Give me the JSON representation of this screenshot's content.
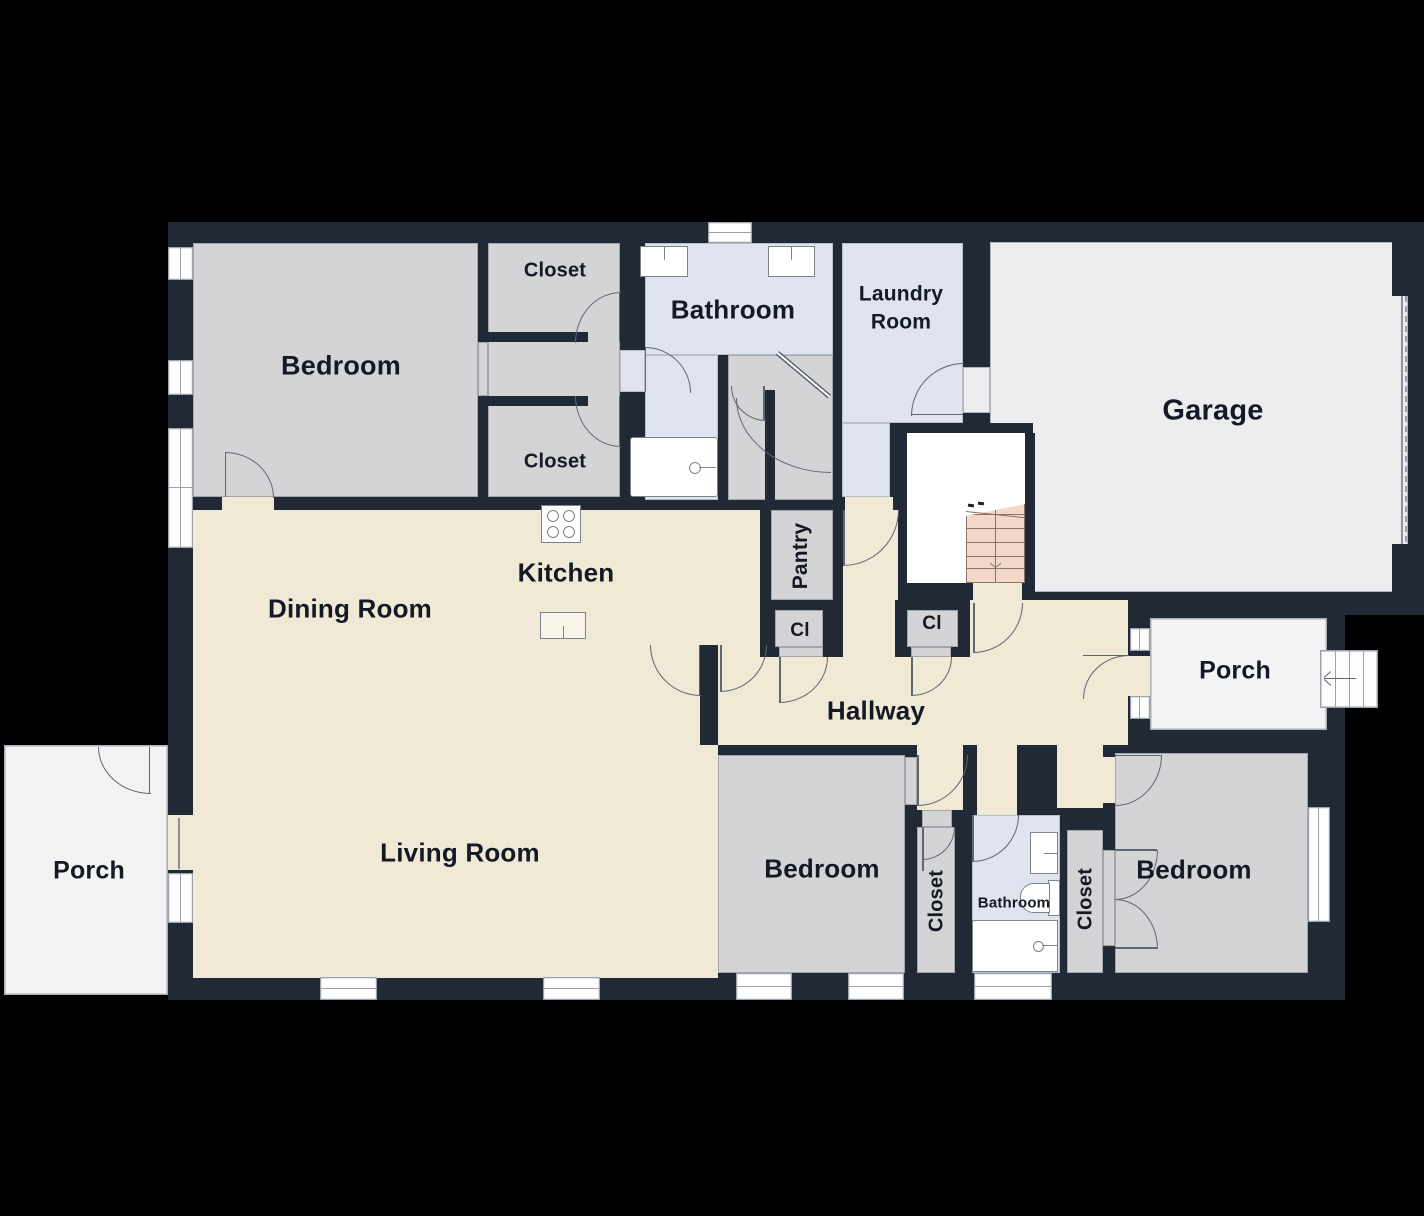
{
  "title": "Single-story house floor plan",
  "rooms": {
    "bedroom_tl": {
      "label": "Bedroom"
    },
    "closet_top": {
      "label": "Closet"
    },
    "closet_mid": {
      "label": "Closet"
    },
    "bathroom_top": {
      "label": "Bathroom"
    },
    "laundry": {
      "label": "Laundry Room"
    },
    "garage": {
      "label": "Garage"
    },
    "kitchen": {
      "label": "Kitchen"
    },
    "dining": {
      "label": "Dining Room"
    },
    "pantry": {
      "label": "Pantry"
    },
    "closet_cl_left": {
      "label": "Cl"
    },
    "closet_cl_right": {
      "label": "Cl"
    },
    "hallway": {
      "label": "Hallway"
    },
    "porch_right": {
      "label": "Porch"
    },
    "porch_left": {
      "label": "Porch"
    },
    "living": {
      "label": "Living Room"
    },
    "bedroom_bl": {
      "label": "Bedroom"
    },
    "closet_bl": {
      "label": "Closet"
    },
    "bathroom_small": {
      "label": "Bathroom"
    },
    "closet_br": {
      "label": "Closet"
    },
    "bedroom_br": {
      "label": "Bedroom"
    }
  },
  "fixtures": [
    "stove-icon",
    "kitchen-sink-icon",
    "bathroom-sink-icon",
    "bathtub-icon",
    "toilet-icon",
    "staircase-icon",
    "down-arrow-icon",
    "left-arrow-icon",
    "garage-door-icon",
    "window-icon",
    "door-arc-icon"
  ],
  "colors": {
    "wall": "#212836",
    "open_floor": "#f0e9d5",
    "bedroom_floor": "#d4d4d6",
    "bath_floor": "#dfe4ef",
    "garage_floor": "#ededef",
    "porch_floor": "#f3f3f4",
    "stairs": "#f3d8c7",
    "window": "#ffffff",
    "background": "#000000"
  }
}
